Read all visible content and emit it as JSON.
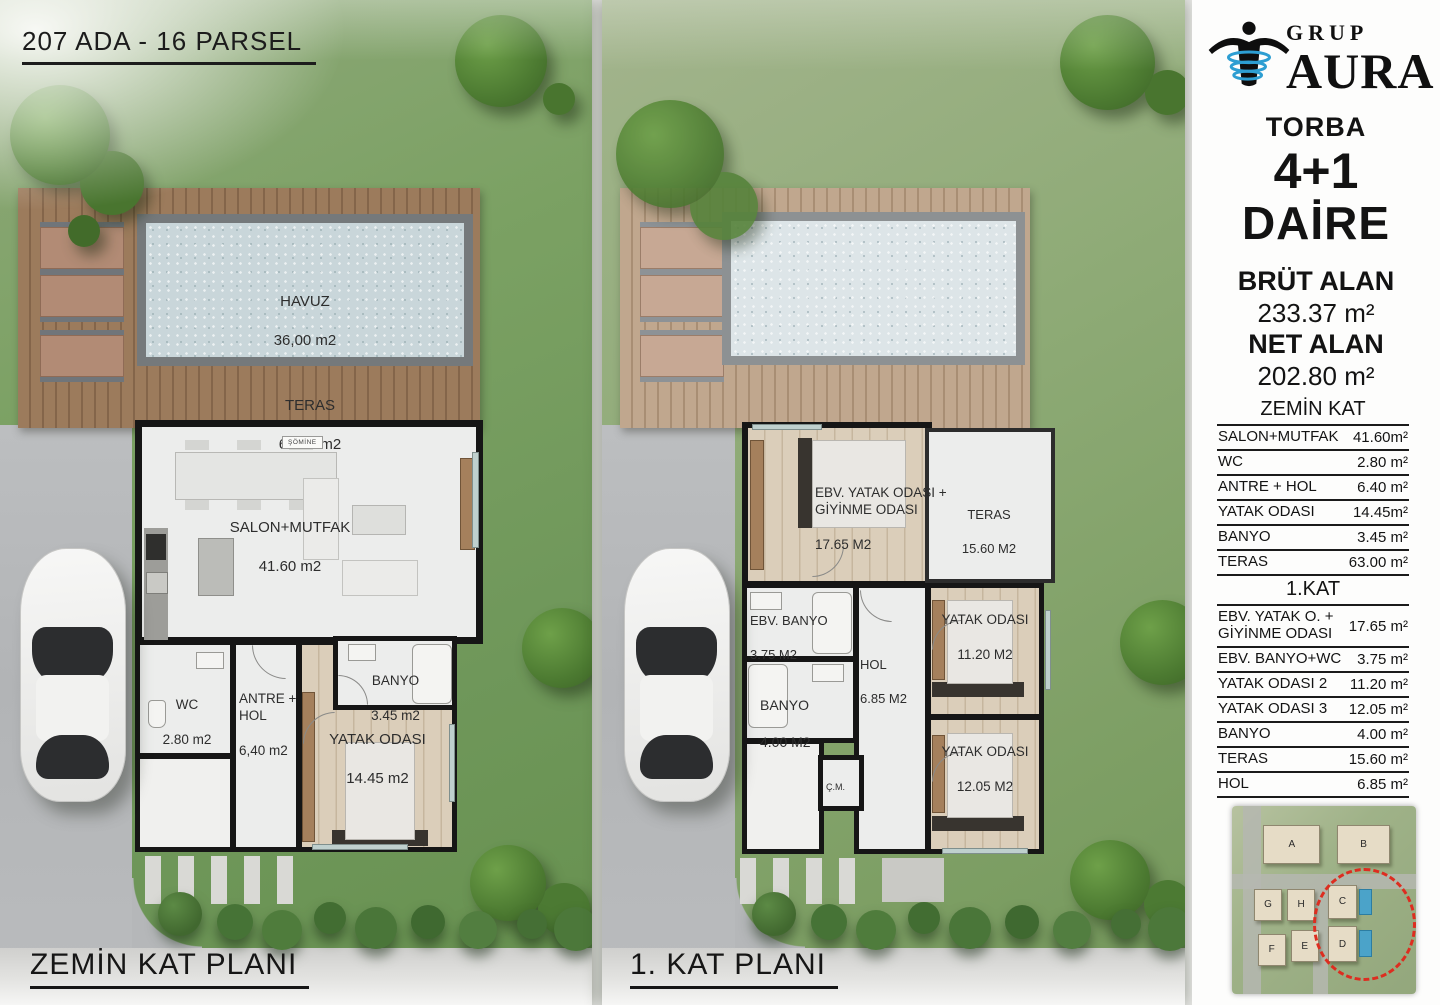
{
  "header": {
    "parcel_title": "207 ADA - 16 PARSEL"
  },
  "ground_plan": {
    "caption": "ZEMİN KAT PLANI",
    "rooms": {
      "havuz": {
        "name": "HAVUZ",
        "area": "36,00 m2"
      },
      "teras": {
        "name": "TERAS",
        "area": "63.00 m2"
      },
      "salon": {
        "name": "SALON+MUTFAK",
        "area": "41.60 m2"
      },
      "somine": {
        "name": "ŞÖMİNE"
      },
      "wc": {
        "name": "WC",
        "area": "2.80 m2"
      },
      "antre": {
        "name": "ANTRE +\nHOL",
        "area": "6,40 m2"
      },
      "banyo": {
        "name": "BANYO",
        "area": "3.45 m2"
      },
      "yatak": {
        "name": "YATAK ODASI",
        "area": "14.45 m2"
      }
    }
  },
  "first_plan": {
    "caption": "1. KAT PLANI",
    "rooms": {
      "ebv_yatak": {
        "name": "EBV. YATAK ODASI +\nGİYİNME ODASI",
        "area": "17.65 M2"
      },
      "teras": {
        "name": "TERAS",
        "area": "15.60 M2"
      },
      "ebv_banyo": {
        "name": "EBV. BANYO",
        "area": "3.75 M2"
      },
      "banyo": {
        "name": "BANYO",
        "area": "4.00 M2"
      },
      "hol": {
        "name": "HOL",
        "area": "6.85 M2"
      },
      "yatak2": {
        "name": "YATAK ODASI",
        "area": "11.20 M2"
      },
      "yatak3": {
        "name": "YATAK ODASI",
        "area": "12.05 M2"
      },
      "cm": {
        "name": "Ç.M."
      }
    }
  },
  "sidebar": {
    "brand": {
      "top": "GRUP",
      "bottom": "AURA"
    },
    "project_name": "TORBA",
    "unit_type": "4+1",
    "unit_word": "DAİRE",
    "gross_label": "BRÜT ALAN",
    "gross_value": "233.37 m²",
    "net_label": "NET ALAN",
    "net_value": "202.80 m²",
    "ground_table": {
      "title": "ZEMİN KAT",
      "rows": [
        {
          "label": "SALON+MUTFAK",
          "value": "41.60m²"
        },
        {
          "label": "WC",
          "value": "2.80 m²"
        },
        {
          "label": "ANTRE + HOL",
          "value": "6.40 m²"
        },
        {
          "label": "YATAK ODASI",
          "value": "14.45m²"
        },
        {
          "label": "BANYO",
          "value": "3.45 m²"
        },
        {
          "label": "TERAS",
          "value": "63.00 m²"
        }
      ]
    },
    "first_table": {
      "title": "1.KAT",
      "rows": [
        {
          "label": "EBV. YATAK O. +\nGİYİNME ODASI",
          "value": "17.65 m²"
        },
        {
          "label": "EBV. BANYO+WC",
          "value": "3.75 m²"
        },
        {
          "label": "YATAK ODASI 2",
          "value": "11.20 m²"
        },
        {
          "label": "YATAK ODASI 3",
          "value": "12.05 m²"
        },
        {
          "label": "BANYO",
          "value": "4.00 m²"
        },
        {
          "label": "TERAS",
          "value": "15.60 m²"
        },
        {
          "label": "HOL",
          "value": "6.85 m²"
        }
      ]
    },
    "siteplan": {
      "buildings": [
        "A",
        "B",
        "G",
        "H",
        "C",
        "F",
        "E",
        "D"
      ]
    }
  },
  "colors": {
    "logo_blue": "#2d9ed2",
    "site_circle_red": "#dd2d20",
    "pool_water": "#c9d6da"
  }
}
